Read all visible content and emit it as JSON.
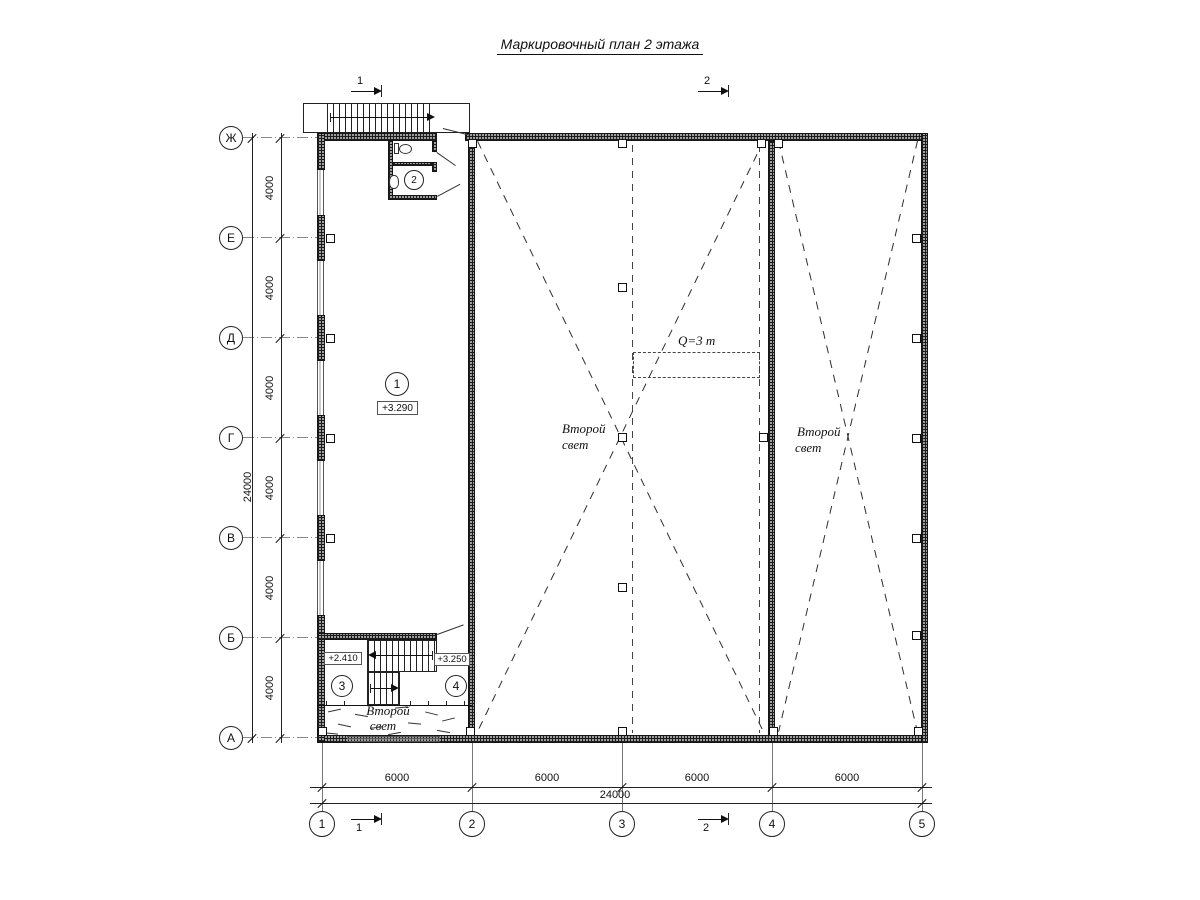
{
  "title": "Маркировочный план 2 этажа",
  "axes": {
    "letters": [
      "Ж",
      "Е",
      "Д",
      "Г",
      "В",
      "Б",
      "А"
    ],
    "numbers": [
      "1",
      "2",
      "3",
      "4",
      "5"
    ]
  },
  "dimensions": {
    "left_segments": [
      "4000",
      "4000",
      "4000",
      "4000",
      "4000",
      "4000"
    ],
    "left_total": "24000",
    "bottom_segments": [
      "6000",
      "6000",
      "6000",
      "6000"
    ],
    "bottom_total": "24000"
  },
  "markers": {
    "room1": "1",
    "room2": "2",
    "room3": "3",
    "room4": "4"
  },
  "elevations": {
    "room1": "+3.290",
    "room3": "+2.410",
    "room4": "+3.250"
  },
  "annotations": {
    "second_light_line1": "Второй",
    "second_light_line2": "свет",
    "crane_capacity": "Q=3 т"
  },
  "section_marks": {
    "mark1": "1",
    "mark2": "2"
  }
}
